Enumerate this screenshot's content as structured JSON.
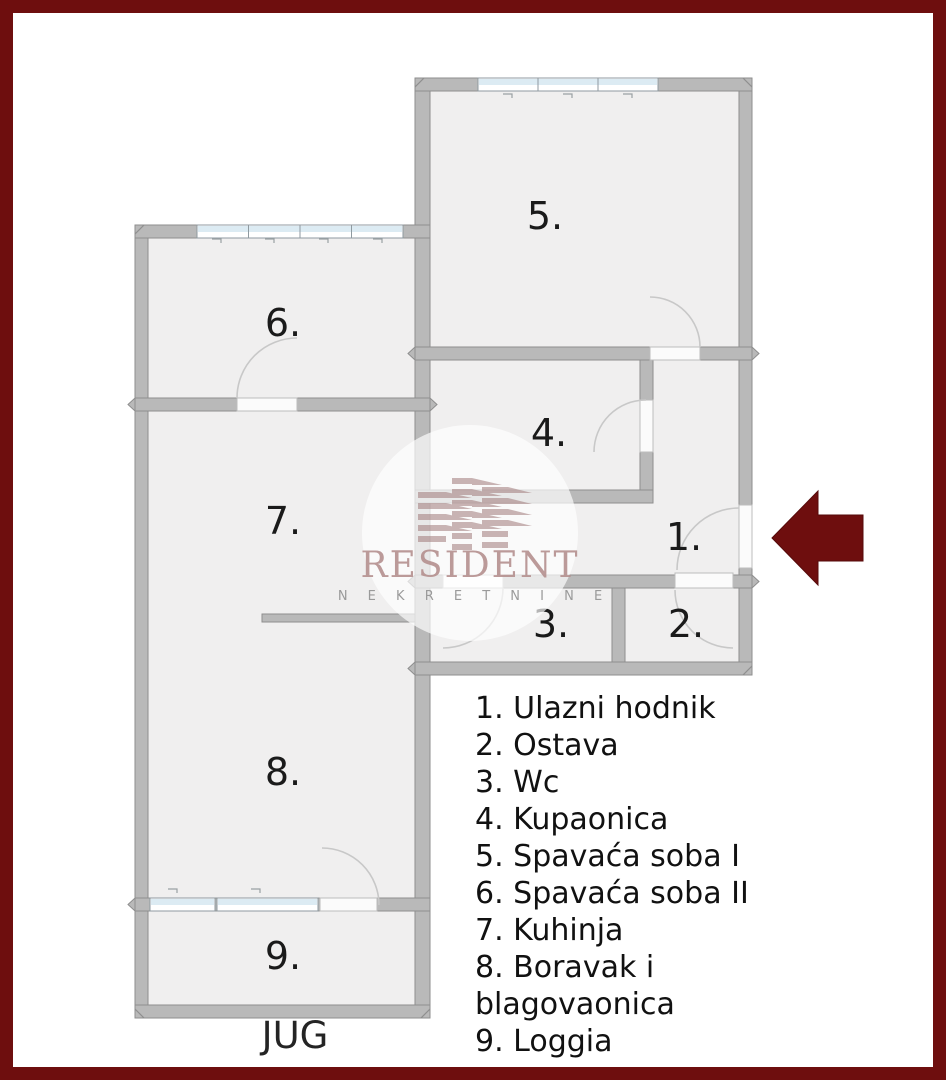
{
  "colors": {
    "frame": "#6e0e0e",
    "arrow": "#6e0e0e",
    "wall": "#b9b9b9",
    "floor": "#f0efef",
    "window_blue": "#dcebf3"
  },
  "plan": {
    "room_labels": {
      "r1": "1.",
      "r2": "2.",
      "r3": "3.",
      "r4": "4.",
      "r5": "5.",
      "r6": "6.",
      "r7": "7.",
      "r8": "8.",
      "r9": "9."
    }
  },
  "watermark": {
    "brand": "RESIDENT",
    "subtitle": "N E K R E T N I N E"
  },
  "legend": {
    "items": [
      "1. Ulazni hodnik",
      "2. Ostava",
      "3. Wc",
      "4. Kupaonica",
      "5. Spavaća soba I",
      "6. Spavaća soba II",
      "7. Kuhinja",
      "8. Boravak i blagovaonica",
      "9. Loggia"
    ]
  },
  "compass": {
    "south_label": "JUG"
  }
}
